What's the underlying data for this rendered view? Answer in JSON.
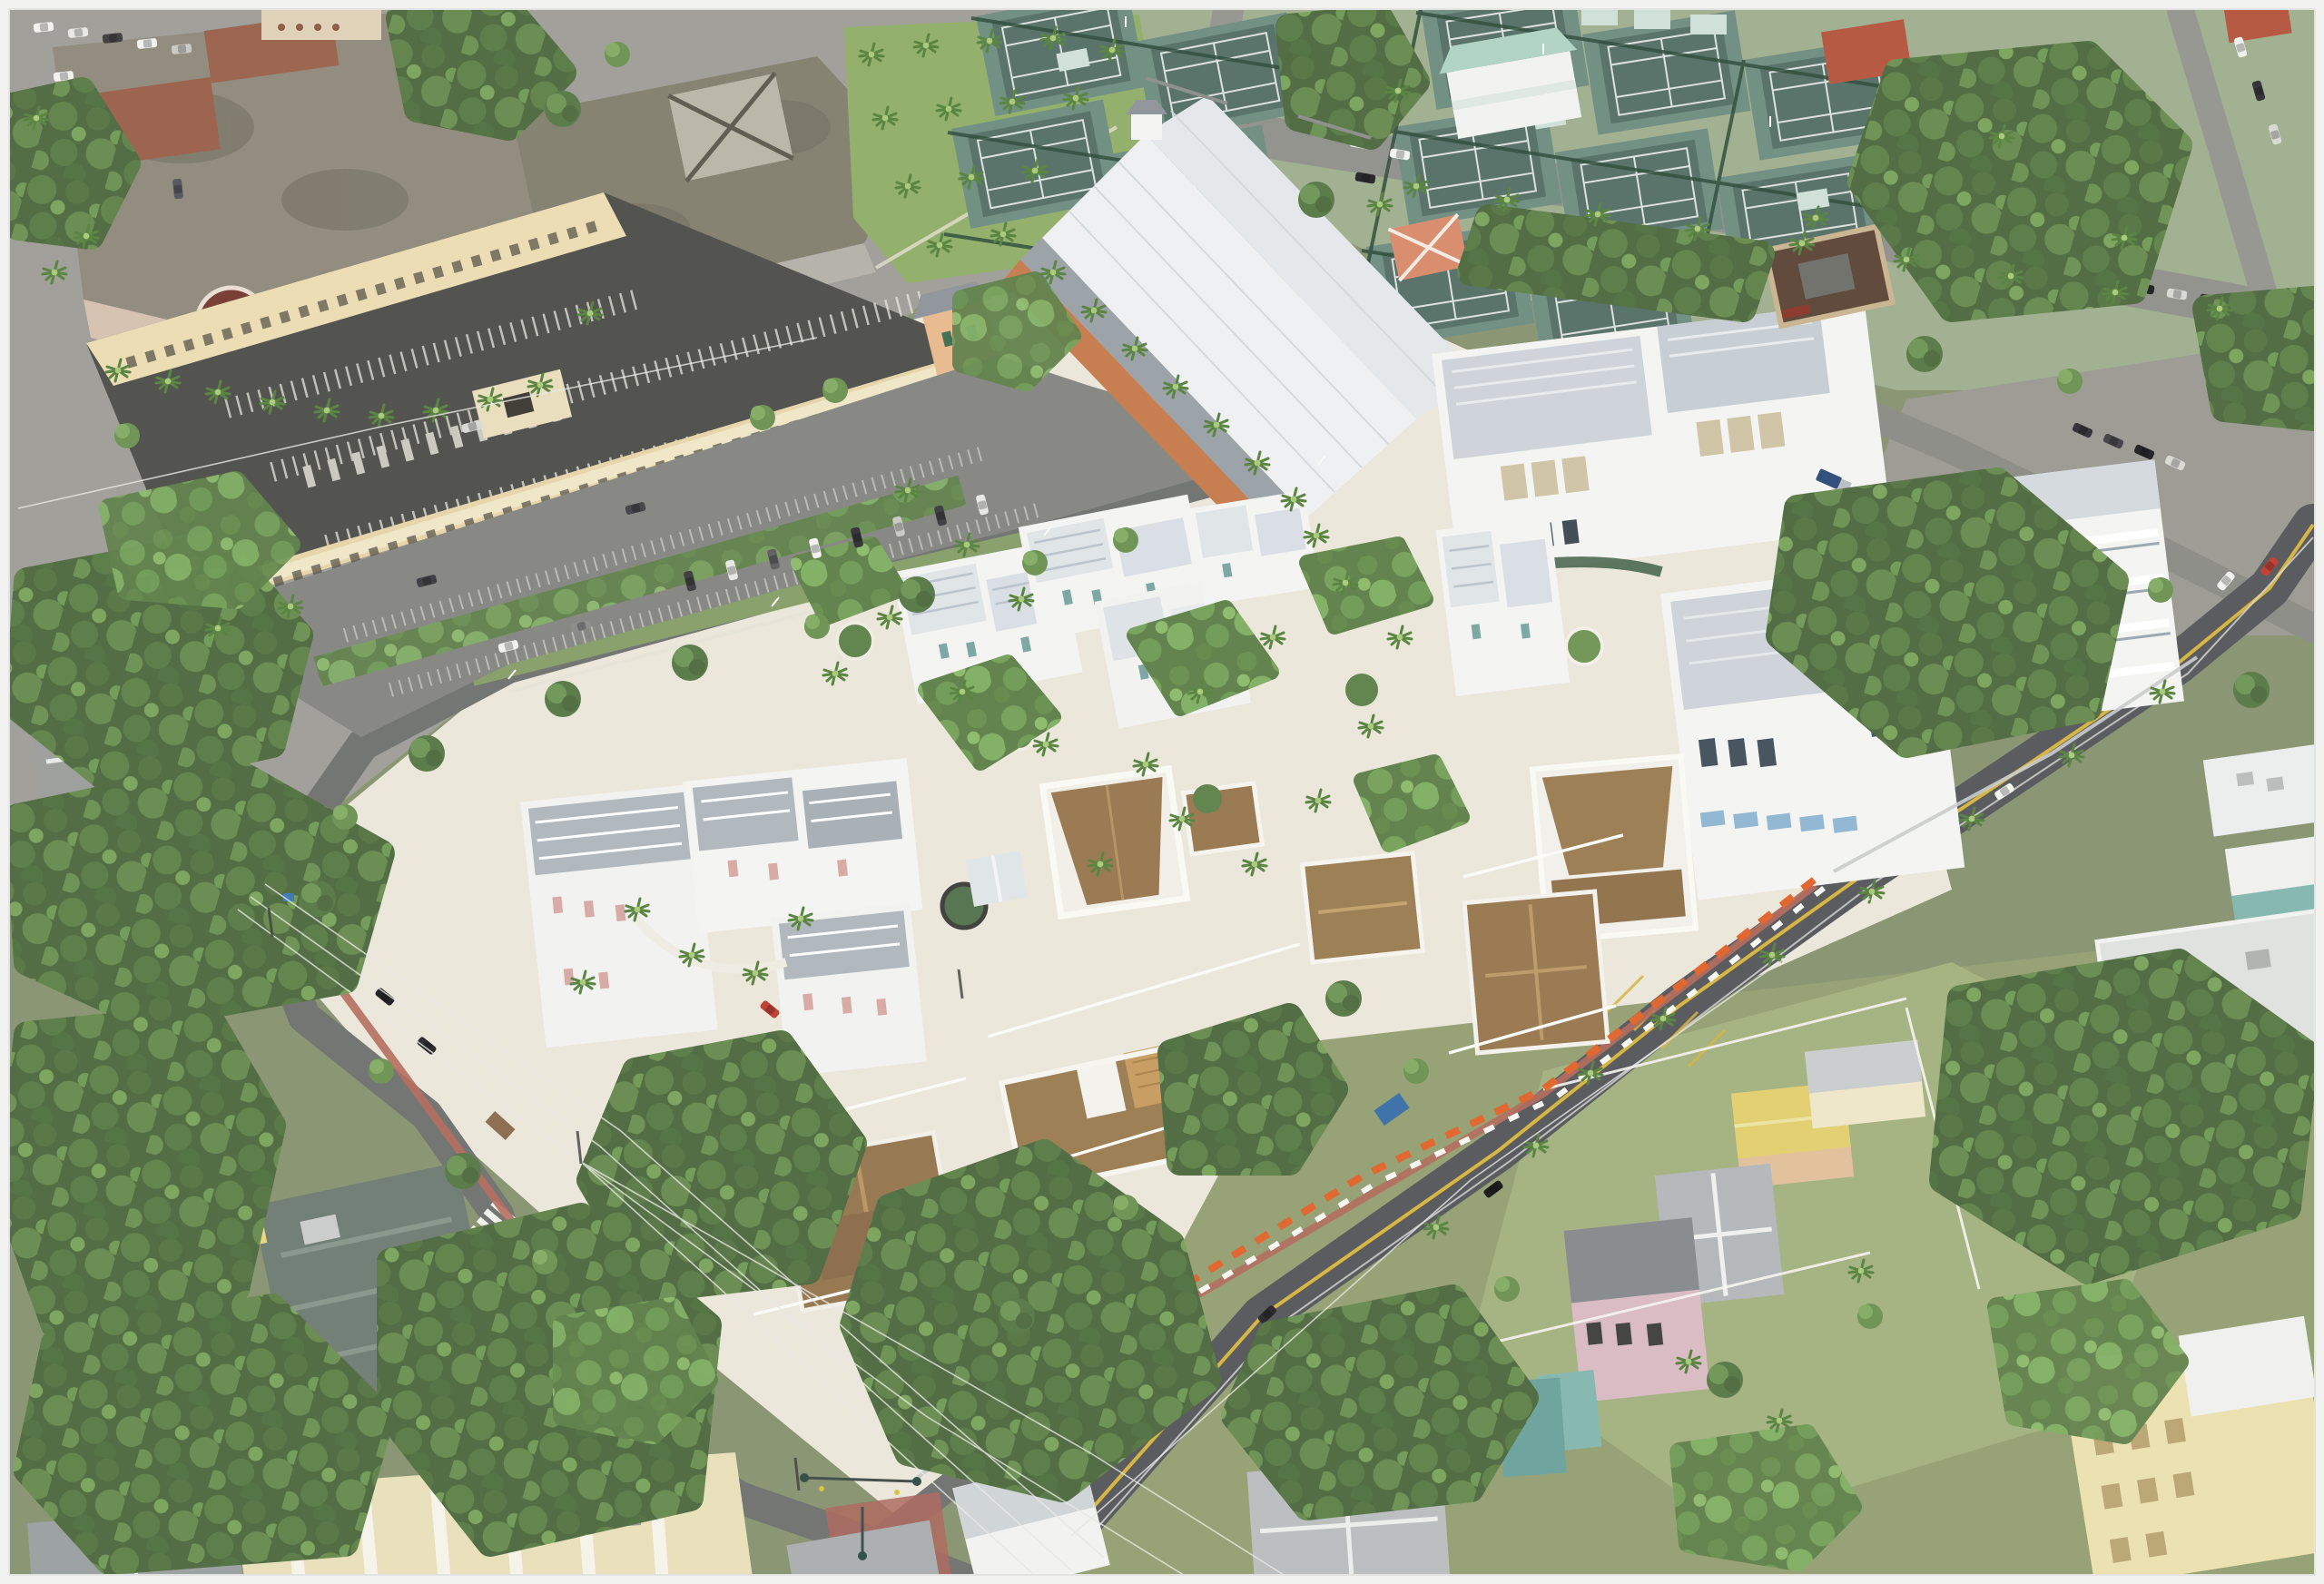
{
  "image": {
    "kind": "aerial-photograph",
    "description": "Oblique aerial photo of a town block: new white mixed-use development with teal- and pink-shuttered townhomes and historic brown-shingle cottages around a cream plaza; flat-roof civic buildings and a beige parking garage upper-left; tennis courts and clubhouse upper-right; a dark diagonal street with double yellow lines and orange construction barriers; dense tree canopy and small houses below; pale frame border around the photo",
    "border": "thin pale frame"
  },
  "palette": {
    "frame": "#f2f3f0",
    "base": "#87936f",
    "plaza": "#ece7da",
    "asphalt": "#8f908a",
    "asphalt_dark": "#54565a",
    "asphalt_mid": "#6f716f",
    "lot": "#84857f",
    "deck_dark": "#4c4d49",
    "garage_beige": "#ecdcb2",
    "civic_roof": "#8e897a",
    "civic_wall": "#d6c1ae",
    "rotunda_red": "#74392f",
    "white_wall": "#f4f4f2",
    "white_roof": "#eef0f1",
    "metal_roof": "#dfe4e8",
    "tile_roof": "#aeb6bc",
    "office_roof": "#ccd3d8",
    "teal_accent": "#79a5a0",
    "pink_accent": "#d8a8a4",
    "shingle": "#96764e",
    "deck_tan": "#c79b5f",
    "court_surface": "#567069",
    "court_apron": "#6e8c81",
    "fence_green": "#2c4a39",
    "mint_roof": "#aed3c2",
    "lawn": "#8fae66",
    "grass_pale": "#a3b07e",
    "canopy_dark": "#47633a",
    "canopy_mid": "#5f8148",
    "canopy_light": "#7da45c",
    "palm_green": "#6f9a4a",
    "brick_walk": "#b3695a",
    "barrier_orange": "#e06228",
    "line_yellow": "#d6b33c",
    "line_white": "#f4f4ef",
    "orange_facade": "#c57a4b",
    "salmon": "#e8b98c",
    "restaurant_brown": "#5a4436",
    "cream_building": "#ece0ae",
    "yellow_roof": "#e2cf6d",
    "pink_house": "#d9bac2",
    "aqua_house": "#84b7ae",
    "cable": "#e8e8e4"
  },
  "scene": {
    "regions": [
      {
        "id": "civic-complex",
        "label": "flat-roof civic buildings with palm-lined tan facade and maroon rotunda"
      },
      {
        "id": "parking-garage-block",
        "label": "beige parking garage with open top deck, stall stripes and salmon stair towers"
      },
      {
        "id": "surface-parking-lot",
        "label": "surface parking lot with tree rows and parked cars"
      },
      {
        "id": "palm-park",
        "label": "lawn with royal palm grove"
      },
      {
        "id": "retail-hall",
        "label": "long white gabled roof hall with orange arcade facade and palm colonnade"
      },
      {
        "id": "office-complex",
        "label": "large white multi-story offices with grey hip roofs, rooftop terrace and blue awnings"
      },
      {
        "id": "townhome-row-teal",
        "label": "white townhomes with standing-seam roofs and teal shutters"
      },
      {
        "id": "townhome-cluster-pink",
        "label": "white townhomes with grey tile hip roofs and pink shutters around garden courtyard"
      },
      {
        "id": "historic-cottages",
        "label": "brown shingle historic cottages with white porches and picket fences"
      },
      {
        "id": "tennis-complex",
        "label": "teal tennis courts with dark green windscreens and mint-roof clubhouse"
      },
      {
        "id": "atlantic-avenue",
        "label": "tree-lined avenue with brick crosswalks and signal gantries"
      },
      {
        "id": "swinton-street",
        "label": "dark repaved street with double yellow line and orange-white construction barriers"
      },
      {
        "id": "west-boundary-street",
        "label": "curving side street with brick sidewalk, crosswalk and signalized intersection"
      },
      {
        "id": "residential-southeast",
        "label": "small houses on grass lots: yellow roof, grey gables, pink and aqua houses, cream corner building"
      },
      {
        "id": "residential-southwest",
        "label": "dense tree canopy with metal-roof cottages and striped warehouse roof"
      },
      {
        "id": "vehicles",
        "label": "parked and moving cars, SUVs, pickup and dump truck"
      },
      {
        "id": "power-lines",
        "label": "overhead utility cables and poles"
      }
    ]
  }
}
